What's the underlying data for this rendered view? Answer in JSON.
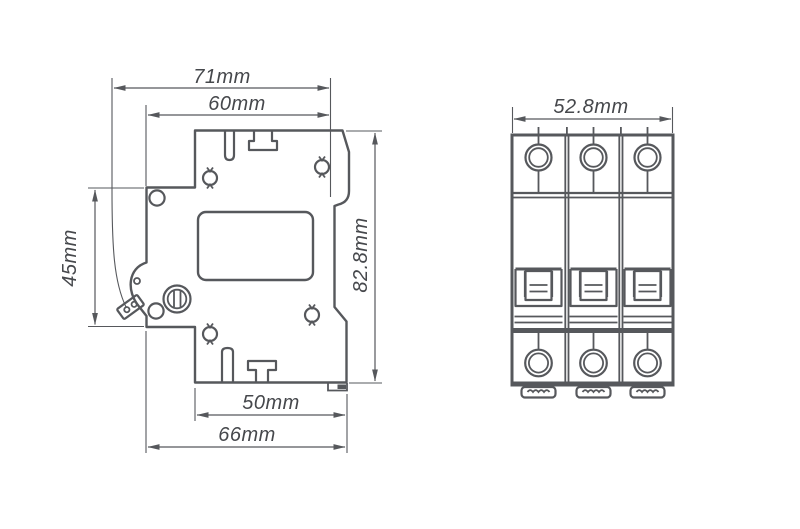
{
  "background": "#ffffff",
  "line_color": "#56585c",
  "text_color": "#46484c",
  "side_view": {
    "name": "circuit-breaker-side-profile",
    "dimensions": {
      "width_total": {
        "label": "71mm"
      },
      "width_top": {
        "label": "60mm"
      },
      "front_height": {
        "label": "45mm"
      },
      "height_total": {
        "label": "82.8mm"
      },
      "width_bottom_inner": {
        "label": "50mm"
      },
      "width_bottom_outer": {
        "label": "66mm"
      }
    }
  },
  "front_view": {
    "name": "circuit-breaker-front-3-pole",
    "pole_count": 3,
    "dimensions": {
      "width_total": {
        "label": "52.8mm"
      }
    }
  }
}
